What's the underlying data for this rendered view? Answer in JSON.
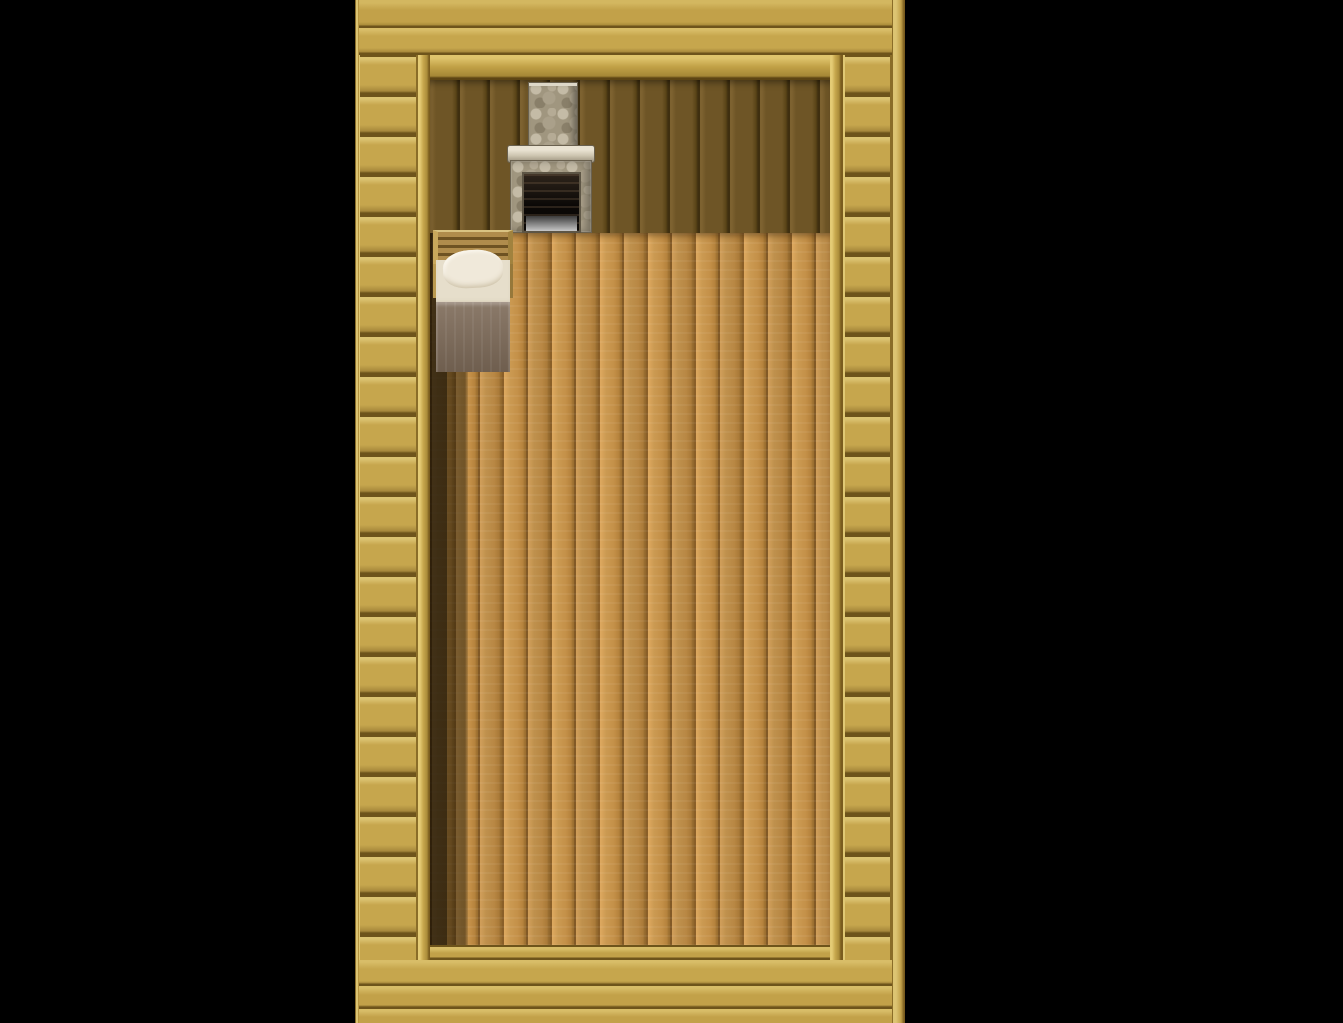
{
  "scene": {
    "name": "wooden-cabin-interior",
    "engine_style": "top-down 2D RPG (RPG Maker style)",
    "description": "Single-room wooden house seen from above: stone fireplace and bookshelf on the north wall, bed on the west wall, round table with three stools in the middle, two clay pots near the east wall, doorway exit at the bottom center. A pink-haired hero in gold armor stands left of the table facing down. Black letterbox fills both sides of the game view.",
    "visible_text": ""
  },
  "palette": {
    "bg": "#000000",
    "wood": "#c2a149",
    "wood_dark": "#6e541b",
    "wood_light": "#dcc472",
    "panel": "#6e5526",
    "panel_dark": "#3f2f10",
    "floor": "#c89349",
    "floor_seam": "#8a5f28",
    "shadow_strip": "#2a1e08",
    "stone": "#a0967f",
    "stone_light": "#c4bba6",
    "opening": "#17120e",
    "mat": "#c08439",
    "blanket": "#7e6b59",
    "pillow": "#f0e9da",
    "shelf_frame": "#6b4a22",
    "shelf_top": "#d8c69c",
    "table_top": "#cfc08c",
    "pot": "#b6ad99",
    "hair": "#d94b78",
    "outfit": "#c9a22f"
  },
  "entities": {
    "player": {
      "label": "hero",
      "facing": "down",
      "hair_color": "#d94b78",
      "eye_color": "#3a66c8",
      "outfit_color": "#c9a22f"
    },
    "fireplace": {
      "label": "stone fireplace with chimney",
      "state": "unlit"
    },
    "bed": {
      "label": "single bed with pillow and brown blanket"
    },
    "bookshelf": {
      "label": "bookshelf full of colored books",
      "shelves": 3
    },
    "table": {
      "label": "round wooden table"
    },
    "stools": {
      "label": "round stool",
      "count": 3,
      "positions": [
        "north of table",
        "east of table",
        "south of table"
      ]
    },
    "pots": {
      "label": "clay pot",
      "count": 2
    },
    "door": {
      "label": "doorway exit",
      "position": "bottom center"
    }
  },
  "bookshelf_rows": [
    {
      "items": [
        {
          "c": "#2e6f7d",
          "h": 22
        },
        {
          "c": "#c85f2a",
          "h": 24
        },
        {
          "c": "#8a3a8f",
          "h": 23,
          "lean": -8
        },
        {
          "c": "#6a4fa0",
          "h": 25,
          "lean": -12
        },
        {
          "c": "#24407c",
          "h": 22
        },
        {
          "c": "#3a6fd0",
          "h": 24
        },
        {
          "c": "#d0702e",
          "h": 21
        },
        {
          "c": "#2e8f6f",
          "h": 23
        },
        {
          "c": "#b03030",
          "h": 24
        },
        {
          "c": "#24407c",
          "h": 22
        },
        {
          "c": "#c8a028",
          "h": 21
        },
        {
          "c": "#3a6fd0",
          "h": 24
        },
        {
          "c": "#b03030",
          "h": 23
        },
        {
          "c": "#2e6f7d",
          "h": 22
        }
      ]
    },
    {
      "items": [
        {
          "c": "#4a8f3a",
          "h": 22
        },
        {
          "c": "#7a4fa0",
          "h": 24
        },
        {
          "c": "#b03030",
          "h": 22
        },
        {
          "c": "#3a6fd0",
          "h": 23
        },
        {
          "c": "#2e8f6f",
          "h": 22
        },
        {
          "c": "#d04a80",
          "h": 24,
          "lean": -14
        },
        {
          "c": "#b03030",
          "h": 22
        },
        {
          "stack": [
            "#d0a02e",
            "#c8902e",
            "#b87828"
          ]
        },
        {
          "stack": [
            "#b04028",
            "#c85f2a"
          ]
        },
        {
          "c": "#b03030",
          "h": 23,
          "lean": 10
        }
      ]
    },
    {
      "items": [
        {
          "stack": [
            "#c8902e",
            "#d0a02e",
            "#b87828"
          ]
        },
        {
          "c": "#6a4fa0",
          "h": 24,
          "lean": -14
        },
        {
          "c": "#3a6fd0",
          "h": 23,
          "lean": -10
        },
        {
          "c": "#c84fa0",
          "h": 22,
          "lean": -6
        },
        {
          "gap": 8
        },
        {
          "c": "#3a6fd0",
          "h": 24,
          "lean": -16
        },
        {
          "c": "#c85f2a",
          "h": 21
        },
        {
          "c": "#2e8f6f",
          "h": 23
        },
        {
          "c": "#24407c",
          "h": 22
        },
        {
          "c": "#4a8f3a",
          "h": 21
        },
        {
          "c": "#2e6f7d",
          "h": 23
        }
      ]
    }
  ]
}
